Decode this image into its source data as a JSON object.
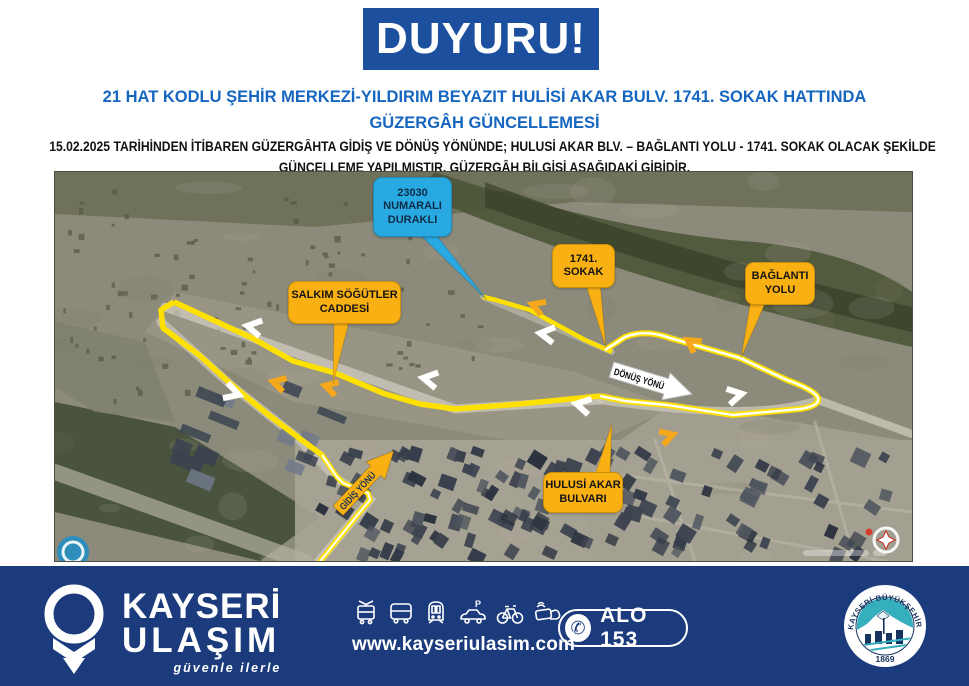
{
  "banner": {
    "title": "DUYURU!"
  },
  "heading": {
    "line1": "21 HAT KODLU ŞEHİR MERKEZİ-YILDIRIM BEYAZIT HULİSİ AKAR BULV. 1741. SOKAK HATTINDA",
    "line2": "GÜZERGÂH GÜNCELLEMESİ"
  },
  "description": {
    "line1": "15.02.2025 TARİHİNDEN İTİBAREN GÜZERGÂHTA GİDİŞ VE DÖNÜŞ YÖNÜNDE; HULUSİ AKAR BLV. – BAĞLANTI YOLU  - 1741. SOKAK OLACAK ŞEKİLDE",
    "line2": "GÜNCELLEME YAPILMIŞTIR. GÜZERGÂH BİLGİSİ AŞAĞIDAKİ GİBİDİR."
  },
  "map": {
    "callouts": {
      "stop": {
        "line1": "23030",
        "line2": "NUMARALI",
        "line3": "DURAKLI"
      },
      "sokak1741": {
        "line1": "1741.",
        "line2": "SOKAK"
      },
      "baglanti": {
        "line1": "BAĞLANTI",
        "line2": "YOLU"
      },
      "salkim": {
        "line1": "SALKIM SÖĞÜTLER",
        "line2": "CADDESİ"
      },
      "hulusi": {
        "line1": "HULUSİ AKAR",
        "line2": "BULVARI"
      },
      "donus": {
        "label": "DÖNÜŞ YÖNÜ"
      },
      "gidis": {
        "label": "GİDİŞ YÖNÜ"
      }
    },
    "colors": {
      "route_yellow": "#FFE100",
      "chevron_orange": "#F5A81C",
      "callout_yellow": "#F9B012",
      "callout_blue": "#29A9E1"
    }
  },
  "footer": {
    "brand": {
      "line1": "KAYSERİ",
      "line2": "ULAŞIM",
      "tagline": "güvenle ilerle"
    },
    "website": "www.kayseriulasim.com",
    "hotline": {
      "label": "ALO 153",
      "phone_glyph": "✆"
    },
    "seal": {
      "ring_text": "KAYSERİ BÜYÜKŞEHİR BELEDİYESİ",
      "year": "1869"
    }
  },
  "theme": {
    "banner_blue": "#1D4F9F",
    "heading_blue": "#1666C0",
    "footer_navy": "#1B3B7D"
  }
}
